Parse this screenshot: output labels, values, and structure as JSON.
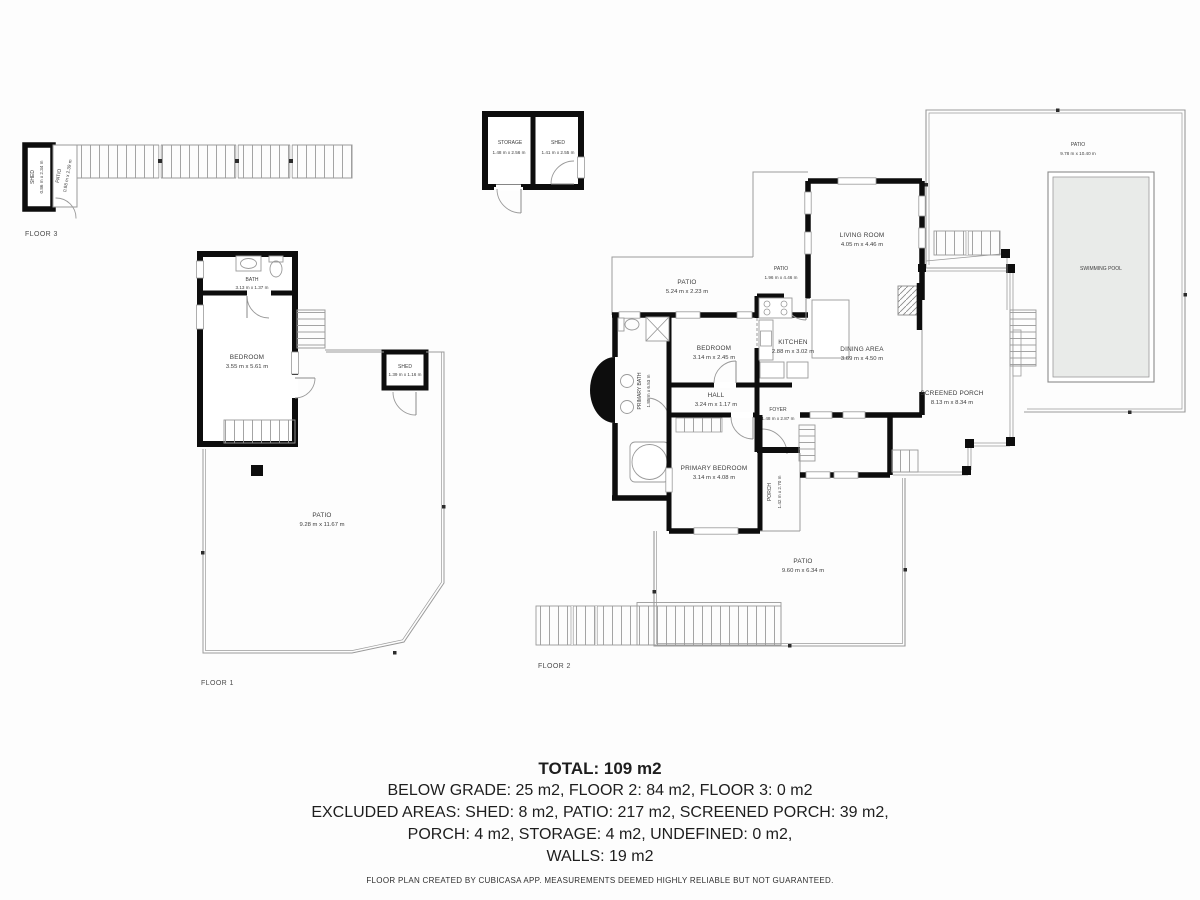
{
  "colors": {
    "wall": "#0d0d0d",
    "thin_line": "#9a9a9a",
    "pool_fill": "#e9ebe9",
    "label_text": "#3d3d3d",
    "summary_text": "#1e1e1e"
  },
  "floor3": {
    "label": "FLOOR 3",
    "shed_name": "SHED",
    "shed_dims": "0.86 m x 2.34 m",
    "patio_name": "PATIO",
    "patio_dims": "0.88 m x 2.39 m"
  },
  "outbuilding": {
    "storage_name": "STORAGE",
    "storage_dims": "1.48 m x 2.56 m",
    "shed_name": "SHED",
    "shed_dims": "1.41 m x 2.55 m"
  },
  "floor1": {
    "label": "FLOOR 1",
    "bath_name": "BATH",
    "bath_dims": "3.13 m x 1.37 m",
    "bedroom_name": "BEDROOM",
    "bedroom_dims": "3.55 m x 5.61 m",
    "shed_name": "SHED",
    "shed_dims": "1.39 m x 1.16 m",
    "patio_name": "PATIO",
    "patio_dims": "9.28 m x 11.67 m"
  },
  "floor2": {
    "label": "FLOOR 2",
    "patio_top_name": "PATIO",
    "patio_top_dims": "5.24 m x 2.23 m",
    "patio_side_name": "PATIO",
    "patio_side_dims": "1.96 m x 4.46 m",
    "living_name": "LIVING ROOM",
    "living_dims": "4.05 m x 4.46 m",
    "bedroom_name": "BEDROOM",
    "bedroom_dims": "3.14 m x 2.45 m",
    "kitchen_name": "KITCHEN",
    "kitchen_dims": "2.88 m x 3.02 m",
    "dining_name": "DINING AREA",
    "dining_dims": "3.69 m x 4.50 m",
    "primary_bath_name": "PRIMARY BATH",
    "primary_bath_dims": "1.85 m x 6.53 m",
    "hall_name": "HALL",
    "hall_dims": "3.24 m x 1.17 m",
    "foyer_name": "FOYER",
    "foyer_dims": "1.48 m x 2.87 m",
    "primary_bedroom_name": "PRIMARY BEDROOM",
    "primary_bedroom_dims": "3.14 m x 4.08 m",
    "porch_name": "PORCH",
    "porch_dims": "1.42 m x 2.70 m",
    "screened_porch_name": "SCREENED PORCH",
    "screened_porch_dims": "8.13 m x 8.34 m",
    "patio_bottom_name": "PATIO",
    "patio_bottom_dims": "9.60 m x 6.34 m",
    "patio_pool_name": "PATIO",
    "patio_pool_dims": "9.78 m x 10.40 m",
    "pool_name": "SWIMMING POOL"
  },
  "summary": {
    "total": "TOTAL: 109 m2",
    "line1": "BELOW GRADE: 25 m2, FLOOR 2: 84 m2, FLOOR 3: 0 m2",
    "line2": "EXCLUDED AREAS: SHED: 8 m2, PATIO: 217 m2, SCREENED PORCH: 39 m2,",
    "line3": "PORCH: 4 m2, STORAGE: 4 m2, UNDEFINED: 0 m2,",
    "line4": "WALLS: 19 m2",
    "disclaimer": "FLOOR PLAN CREATED BY CUBICASA APP. MEASUREMENTS DEEMED HIGHLY RELIABLE BUT NOT GUARANTEED."
  }
}
